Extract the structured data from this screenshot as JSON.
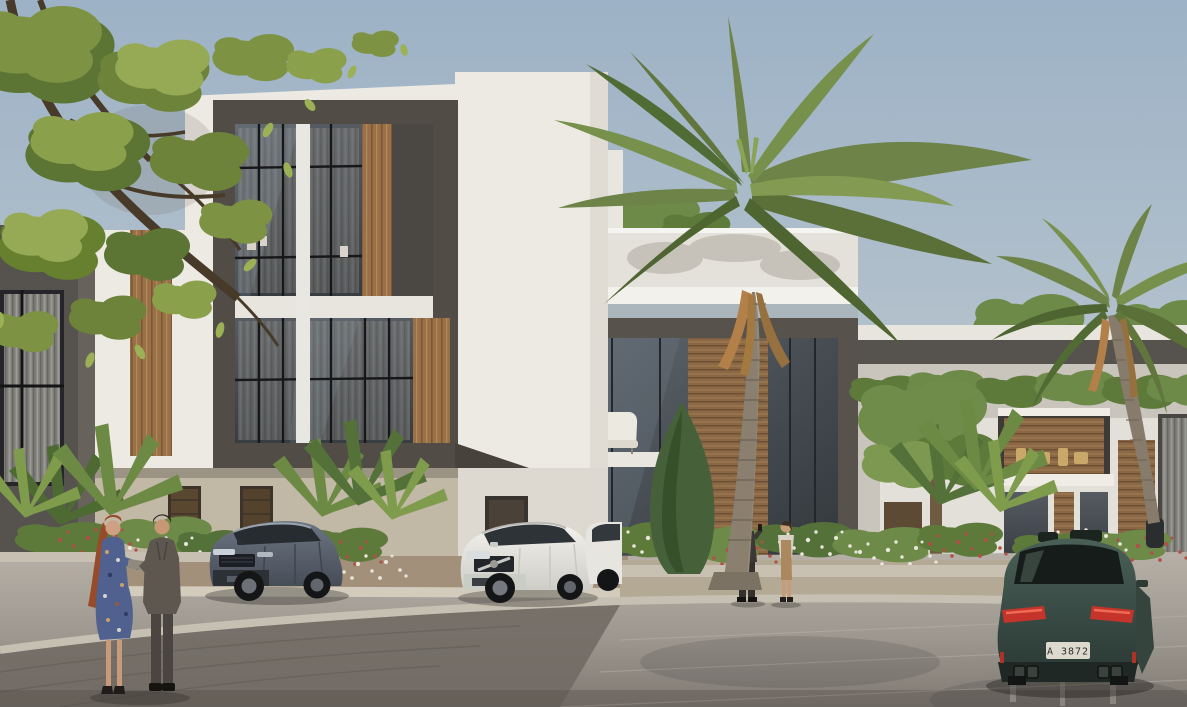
{
  "scene": {
    "type": "architectural-render",
    "description": "Photorealistic exterior rendering of a modern two-storey townhouse community with palm trees, landscaped flower beds, a paved circular driveway, three SUVs and two couples of residents",
    "sky": {
      "label": "clear sky",
      "color_top": "#9db2c6",
      "color_bottom": "#cdd3d5"
    },
    "buildings": {
      "left_villa": {
        "label": "left townhouse with charcoal frame, white stucco, wood panels and glass curtain wall",
        "frame_color": "#514c46",
        "wall_color": "#edeae3",
        "wood_color": "#9a7147",
        "ground_floor_color": "#c1b8a5"
      },
      "center_villa": {
        "label": "center townhouse with double-height glazing, wood slats and white roof parapet",
        "frame_color": "#57524b",
        "parapet_color": "#e6e3dc"
      },
      "right_row": {
        "label": "background townhouse row with balconies, wood slats and roof hedge",
        "wall_color": "#e3e0d9"
      }
    },
    "vegetation": {
      "foreground_tree": {
        "label": "leafy tree overhanging top-left corner",
        "leaf_color": "#87a04a"
      },
      "large_palm": {
        "label": "tall coconut palm in front of center villa",
        "frond_color": "#6e8347",
        "trunk_color": "#8b8070"
      },
      "right_palm": {
        "label": "smaller palm on the right",
        "frond_color": "#6e8347"
      },
      "cypress": {
        "label": "slender cypress by the glass facade",
        "color": "#46613a"
      },
      "flower_beds": {
        "label": "planting beds with fan palms, white and red flowers",
        "flower_white": "#e9e6db",
        "flower_red": "#b05048"
      }
    },
    "road": {
      "label": "curved paver driveway with stone curb",
      "paver_light": "#b6b0a7",
      "paver_dark": "#6f6a63",
      "curb_color": "#c6c0b2"
    },
    "vehicles": {
      "parked_gray_suv": {
        "label": "gray-blue luxury SUV parked at left entrance",
        "color": "#5b6470"
      },
      "parked_white_suv": {
        "label": "white compact SUV parked at center entrance",
        "color": "#eceae5"
      },
      "second_white_car": {
        "label": "partially visible white car",
        "color": "#e7e5e0"
      },
      "driving_teal_suv": {
        "label": "dark teal sport SUV driving away, rear view",
        "color": "#3c4f48",
        "license_plate": "A 3872",
        "taillight_color": "#c5342a"
      }
    },
    "people": {
      "couple_left": {
        "label": "strolling couple: woman with red hair in blue floral dress, man in gray suit",
        "dress_color": "#50608f",
        "suit_color": "#5d5750"
      },
      "couple_center": {
        "label": "conversing pair: man in dark suit, woman in cream blazer and tan dress",
        "suit_color": "#3c3835",
        "blazer_color": "#d8d2c6"
      }
    }
  }
}
